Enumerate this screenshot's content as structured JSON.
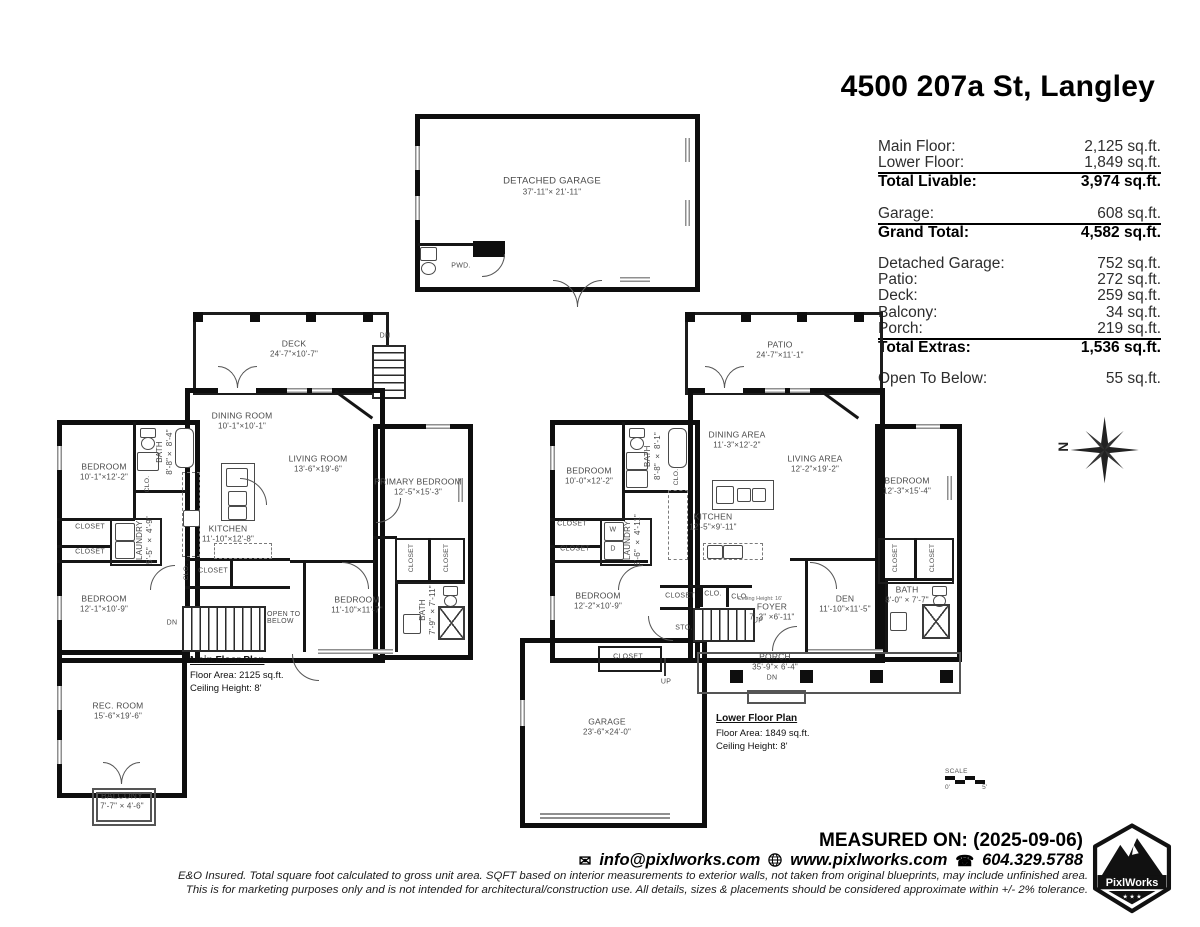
{
  "title": "4500 207a St, Langley",
  "area_table": {
    "rows": [
      {
        "label": "Main Floor:",
        "value": "2,125 sq.ft."
      },
      {
        "label": "Lower Floor:",
        "value": "1,849 sq.ft."
      },
      {
        "label": "Total Livable:",
        "value": "3,974 sq.ft."
      },
      {
        "label": "Garage:",
        "value": "608 sq.ft."
      },
      {
        "label": "Grand Total:",
        "value": "4,582 sq.ft."
      },
      {
        "label": "Detached Garage:",
        "value": "752 sq.ft."
      },
      {
        "label": "Patio:",
        "value": "272 sq.ft."
      },
      {
        "label": "Deck:",
        "value": "259 sq.ft."
      },
      {
        "label": "Balcony:",
        "value": "34 sq.ft."
      },
      {
        "label": "Porch:",
        "value": "219 sq.ft."
      },
      {
        "label": "Total Extras:",
        "value": "1,536 sq.ft."
      },
      {
        "label": "Open To Below:",
        "value": "55 sq.ft."
      }
    ]
  },
  "detached_garage": {
    "name": "DETACHED GARAGE",
    "dims": "37'-11\"× 21'-11\""
  },
  "labels": {
    "closet": "CLOSET",
    "clo": "CLO.",
    "sto": "STO.",
    "dn": "DN",
    "up": "UP",
    "w": "W",
    "d": "D",
    "open_to_below": "OPEN TO BELOW",
    "pwd": "PWD."
  },
  "main_floor": {
    "footnote": {
      "heading": "Main Floor Plan",
      "area": "Floor Area: 2125 sq.ft.",
      "ceiling": "Ceiling Height: 8'"
    },
    "rooms": {
      "deck": {
        "name": "DECK",
        "dims": "24'-7\"×10'-7\""
      },
      "dining": {
        "name": "DINING ROOM",
        "dims": "10'-1\"×10'-1\""
      },
      "living": {
        "name": "LIVING ROOM",
        "dims": "13'-6\"×19'-6\""
      },
      "primary": {
        "name": "PRIMARY BEDROOM",
        "dims": "12'-5\"×15'-3\""
      },
      "bedroom1": {
        "name": "BEDROOM",
        "dims": "10'-1\"×12'-2\""
      },
      "bath1": {
        "name": "BATH",
        "dims": "8'-8\"× 8'-4\""
      },
      "kitchen": {
        "name": "KITCHEN",
        "dims": "11'-10\"×12'-8\""
      },
      "laundry": {
        "name": "LAUNDRY",
        "dims": "5'-5\" × 4'-9\""
      },
      "bedroom2": {
        "name": "BEDROOM",
        "dims": "12'-1\"×10'-9\""
      },
      "bedroom3": {
        "name": "BEDROOM",
        "dims": "11'-10\"×11'-7\""
      },
      "bath2": {
        "name": "BATH",
        "dims": "7'-9\" ×7'-11\""
      },
      "rec": {
        "name": "REC. ROOM",
        "dims": "15'-6\"×19'-6\""
      },
      "balcony": {
        "name": "BALCONY",
        "dims": "7'-7\" × 4'-6\""
      }
    }
  },
  "lower_floor": {
    "footnote": {
      "heading": "Lower Floor Plan",
      "area": "Floor Area: 1849 sq.ft.",
      "ceiling": "Ceiling Height: 8'"
    },
    "rooms": {
      "patio": {
        "name": "PATIO",
        "dims": "24'-7\"×11'-1\""
      },
      "dining": {
        "name": "DINING AREA",
        "dims": "11'-3\"×12'-2\""
      },
      "living": {
        "name": "LIVING AREA",
        "dims": "12'-2\"×19'-2\""
      },
      "bedroom_r": {
        "name": "BEDROOM",
        "dims": "12'-3\"×15'-4\""
      },
      "bedroom1": {
        "name": "BEDROOM",
        "dims": "10'-0\"×12'-2\""
      },
      "bath1": {
        "name": "BATH",
        "dims": "8'-8\" × 8'-1\""
      },
      "kitchen": {
        "name": "KITCHEN",
        "dims": "12'-5\"×9'-11\""
      },
      "laundry": {
        "name": "LAUNDRY",
        "dims": "5'-6\" × 4'-11\""
      },
      "bedroom2": {
        "name": "BEDROOM",
        "dims": "12'-2\"×10'-9\""
      },
      "foyer": {
        "name": "FOYER",
        "dims": "7'-3\" ×6'-11\"",
        "note": "Ceiling Height: 16'"
      },
      "den": {
        "name": "DEN",
        "dims": "11'-10\"×11'-5\""
      },
      "bath2": {
        "name": "BATH",
        "dims": "8'-0\" × 7'-7\""
      },
      "garage": {
        "name": "GARAGE",
        "dims": "23'-6\"×24'-0\""
      },
      "porch": {
        "name": "PORCH",
        "dims": "35'-9\"× 6'-4\""
      }
    }
  },
  "compass": {
    "n": "N"
  },
  "scale_bar": {
    "label": "SCALE",
    "start": "0'",
    "end": "5'"
  },
  "footer": {
    "measured_on": "MEASURED ON: (2025-09-06)",
    "email": "info@pixlworks.com",
    "website": "www.pixlworks.com",
    "phone": "604.329.5788",
    "disclaimer1": "E&O Insured.  Total square foot calculated to gross unit area. SQFT based on interior measurements to exterior walls, not taken from original blueprints, may include unfinished area.",
    "disclaimer2": "This is for marketing purposes only and is not intended for architectural/construction use.  All details, sizes & placements should be considered approximate within +/- 2%  tolerance.",
    "brand": "PixlWorks"
  }
}
